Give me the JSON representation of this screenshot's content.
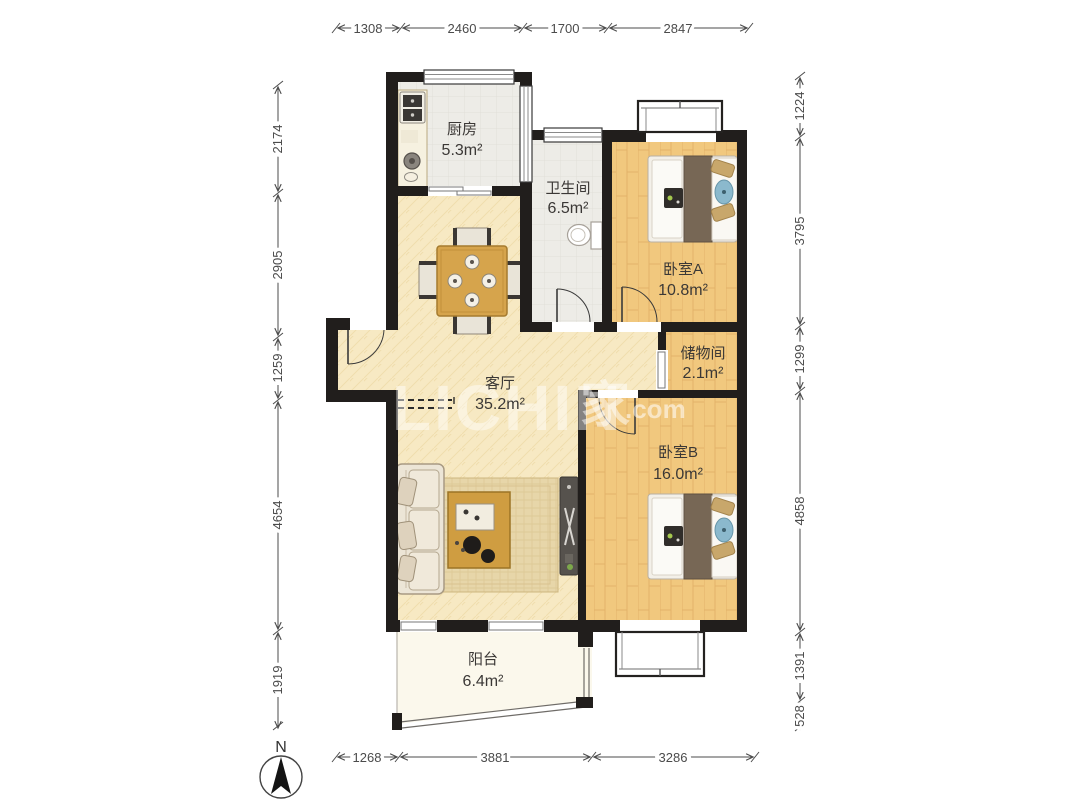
{
  "floorplan": {
    "compass_label": "N",
    "watermark": {
      "latin": "LICHIN",
      "cjk": "家",
      "suffix": ".com"
    },
    "rooms": {
      "kitchen": {
        "name": "厨房",
        "area": "5.3m²"
      },
      "bathroom": {
        "name": "卫生间",
        "area": "6.5m²"
      },
      "bedroom_a": {
        "name": "卧室A",
        "area": "10.8m²"
      },
      "storage": {
        "name": "储物间",
        "area": "2.1m²"
      },
      "living": {
        "name": "客厅",
        "area": "35.2m²"
      },
      "bedroom_b": {
        "name": "卧室B",
        "area": "16.0m²"
      },
      "balcony": {
        "name": "阳台",
        "area": "6.4m²"
      }
    },
    "dimensions_mm": {
      "top": [
        "1308",
        "2460",
        "1700",
        "2847"
      ],
      "bottom": [
        "1268",
        "3881",
        "3286"
      ],
      "left": [
        "2174",
        "2905",
        "1259",
        "4654",
        "1919"
      ],
      "right": [
        "1224",
        "3795",
        "1299",
        "4858",
        "1391",
        "528"
      ]
    },
    "colors": {
      "wall": "#211e1c",
      "wood_floor": "#f1c87e",
      "tile_floor": "#edece7",
      "living_floor": "#f7e9c3",
      "balcony_floor": "#fbf8ec",
      "dim_text": "#4b4b4b",
      "label_text": "#3b3836"
    }
  }
}
